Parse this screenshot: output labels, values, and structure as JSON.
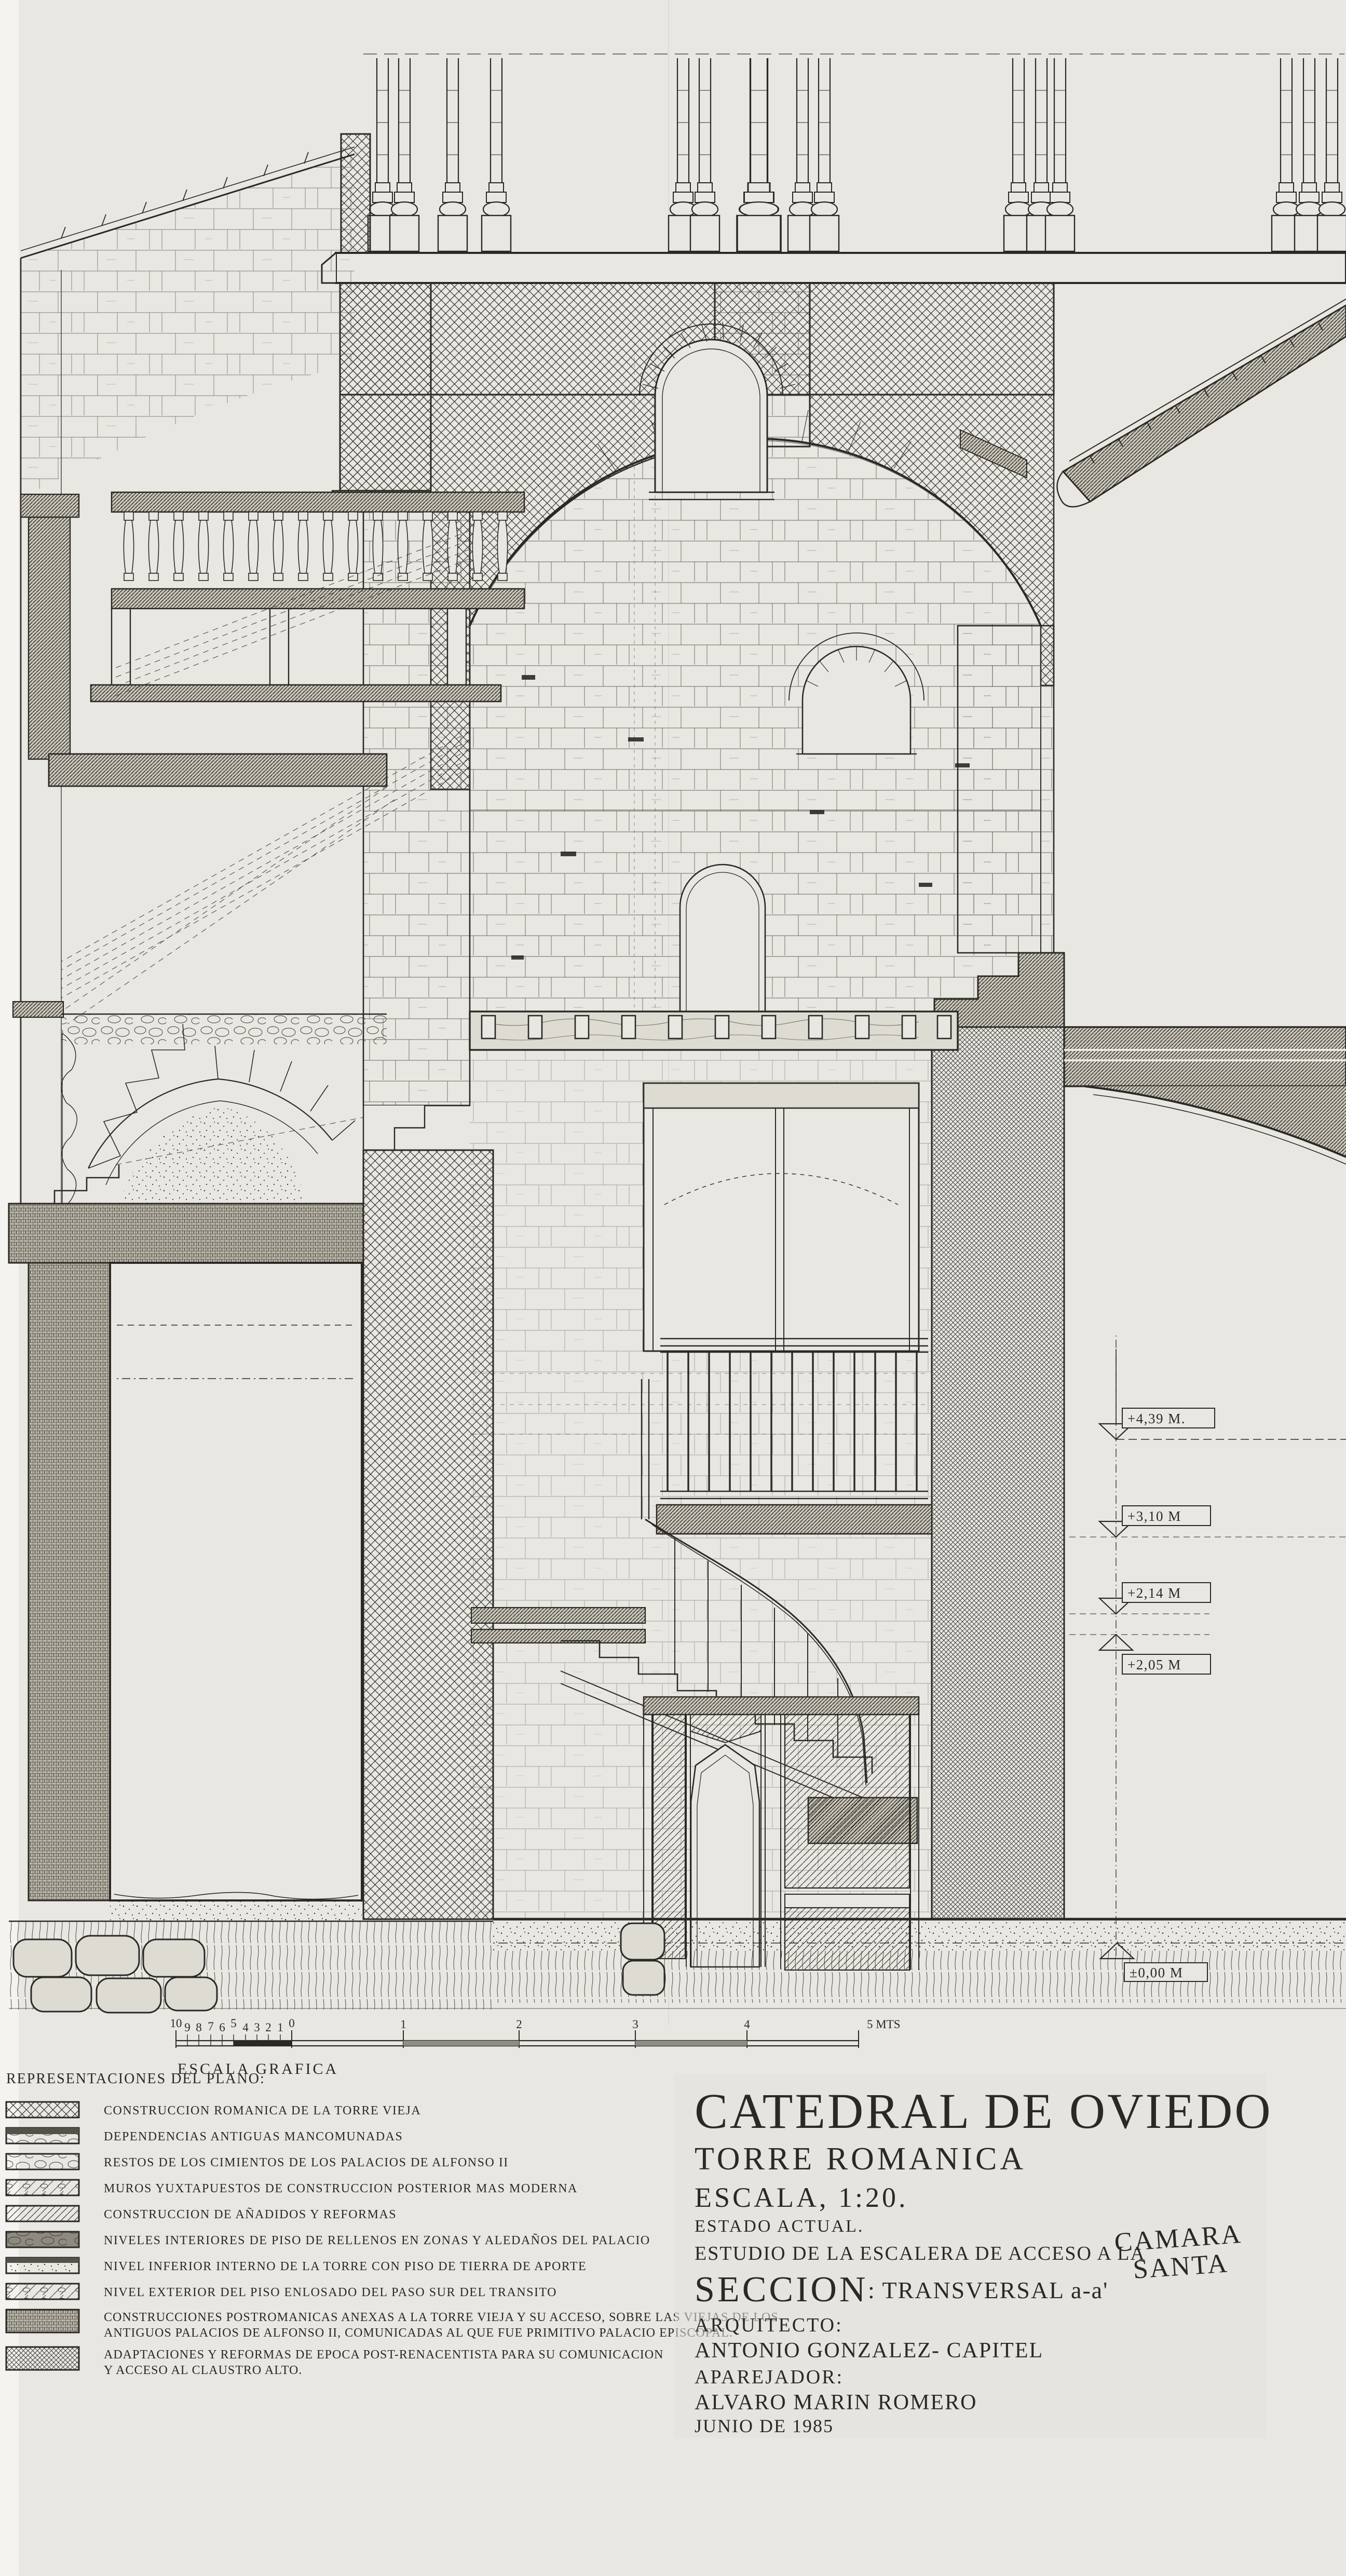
{
  "paper": {
    "bg": "#e9e7e2",
    "ink": "#2b2925",
    "edge_strip": "#f4f3ef"
  },
  "title_block": {
    "project": "CATEDRAL DE OVIEDO",
    "subtitle": "TORRE ROMANICA",
    "scale": "ESCALA, 1:20.",
    "status": "ESTADO ACTUAL.",
    "study": "ESTUDIO DE LA ESCALERA DE ACCESO A LA",
    "study_highlight1": "CAMARA",
    "study_highlight2": "SANTA",
    "section_label": "SECCION",
    "section_detail": ": TRANSVERSAL a-a'",
    "architect_label": "ARQUITECTO:",
    "architect": "ANTONIO GONZALEZ- CAPITEL",
    "surveyor_label": "APAREJADOR:",
    "surveyor": "ALVARO MARIN ROMERO",
    "date": "JUNIO DE 1985"
  },
  "legend": {
    "title": "REPRESENTACIONES DEL PLANO:",
    "items": [
      {
        "pattern": "crosshatch",
        "label": "CONSTRUCCION ROMANICA DE LA TORRE VIEJA"
      },
      {
        "pattern": "old-stone",
        "label": "DEPENDENCIAS ANTIGUAS MANCOMUNADAS"
      },
      {
        "pattern": "rubble",
        "label": "RESTOS DE LOS CIMIENTOS DE LOS PALACIOS DE ALFONSO II"
      },
      {
        "pattern": "mixed-wall",
        "label": "MUROS YUXTAPUESTOS DE CONSTRUCCION POSTERIOR MAS MODERNA"
      },
      {
        "pattern": "diagonal-hatch",
        "label": "CONSTRUCCION DE AÑADIDOS Y REFORMAS"
      },
      {
        "pattern": "dark-fill",
        "label": "NIVELES INTERIORES DE PISO DE RELLENOS EN ZONAS Y ALEDAÑOS DEL PALACIO"
      },
      {
        "pattern": "earth-stipple",
        "label": "NIVEL INFERIOR INTERNO DE LA TORRE CON PISO DE TIERRA DE APORTE"
      },
      {
        "pattern": "paved-hatch",
        "label": "NIVEL EXTERIOR DEL PISO ENLOSADO DEL PASO SUR DEL TRANSITO"
      },
      {
        "pattern": "dense-grid",
        "label": "CONSTRUCCIONES POSTROMANICAS ANEXAS A LA TORRE VIEJA Y SU ACCESO, SOBRE LAS VIEJAS DE LOS",
        "label2": "ANTIGUOS PALACIOS DE ALFONSO II, COMUNICADAS AL QUE FUE PRIMITIVO PALACIO EPISCOPAL."
      },
      {
        "pattern": "fine-crosshatch",
        "label": "ADAPTACIONES Y REFORMAS DE EPOCA POST-RENACENTISTA PARA SU COMUNICACION",
        "label2": "Y ACCESO AL CLAUSTRO ALTO."
      }
    ]
  },
  "scale_bar": {
    "sub_ticks": [
      "10",
      "9",
      "8",
      "7",
      "6",
      "5",
      "4",
      "3",
      "2",
      "1",
      "0"
    ],
    "meters": [
      "1",
      "2",
      "3",
      "4",
      "5 MTS"
    ],
    "caption": "ESCALA GRAFICA"
  },
  "elevation_markers": [
    {
      "label": "+4,39 M."
    },
    {
      "label": "+3,10 M"
    },
    {
      "label": "+2,14 M"
    },
    {
      "label": "+2,05 M"
    },
    {
      "label": "±0,00 M"
    }
  ]
}
